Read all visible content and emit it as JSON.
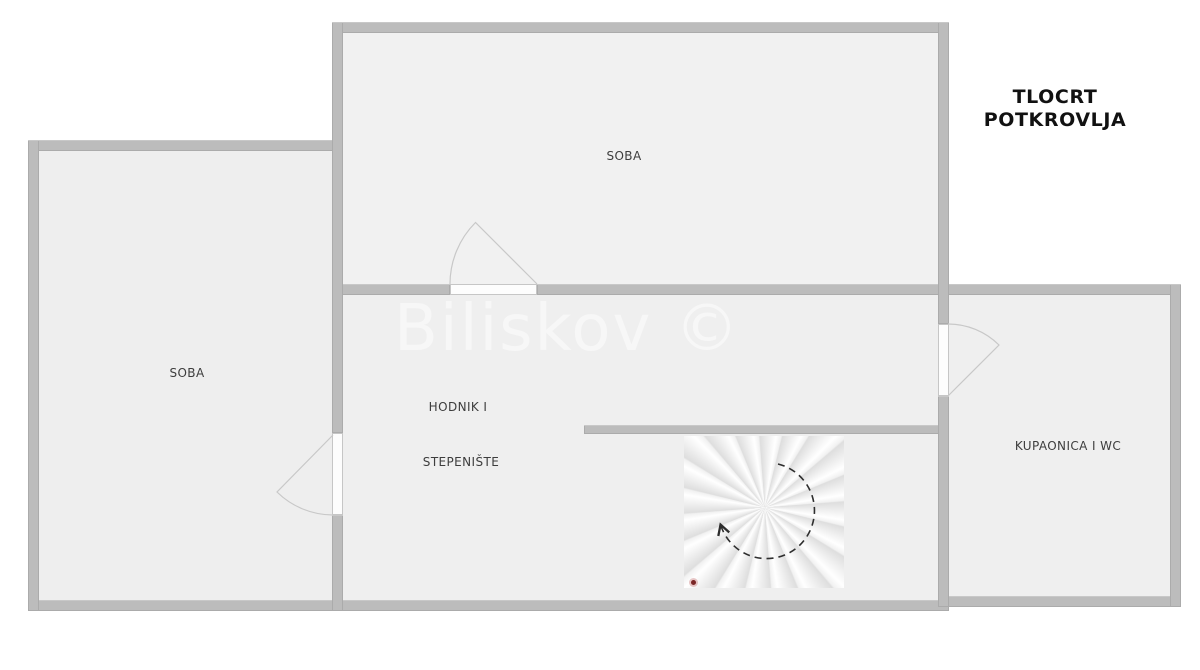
{
  "title": {
    "line1": "TLOCRT",
    "line2": "POTKROVLJA"
  },
  "watermark": "Biliskov ©",
  "rooms": {
    "soba_top": {
      "label": "SOBA"
    },
    "soba_left": {
      "label": "SOBA"
    },
    "hodnik": {
      "label": "HODNIK I"
    },
    "stepeniste": {
      "label": "STEPENIŠTE"
    },
    "kupaonica": {
      "label": "KUPAONICA I WC"
    }
  },
  "colors": {
    "wall": "#bcbcbc",
    "floor": "#efefef",
    "label_text": "#3d3d3d",
    "title_text": "#111111",
    "watermark_text": "#f7f7f7",
    "direction_arrow": "#2e2e2e",
    "door_arc": "#c8c8c8",
    "start_marker": "#7a2626"
  }
}
